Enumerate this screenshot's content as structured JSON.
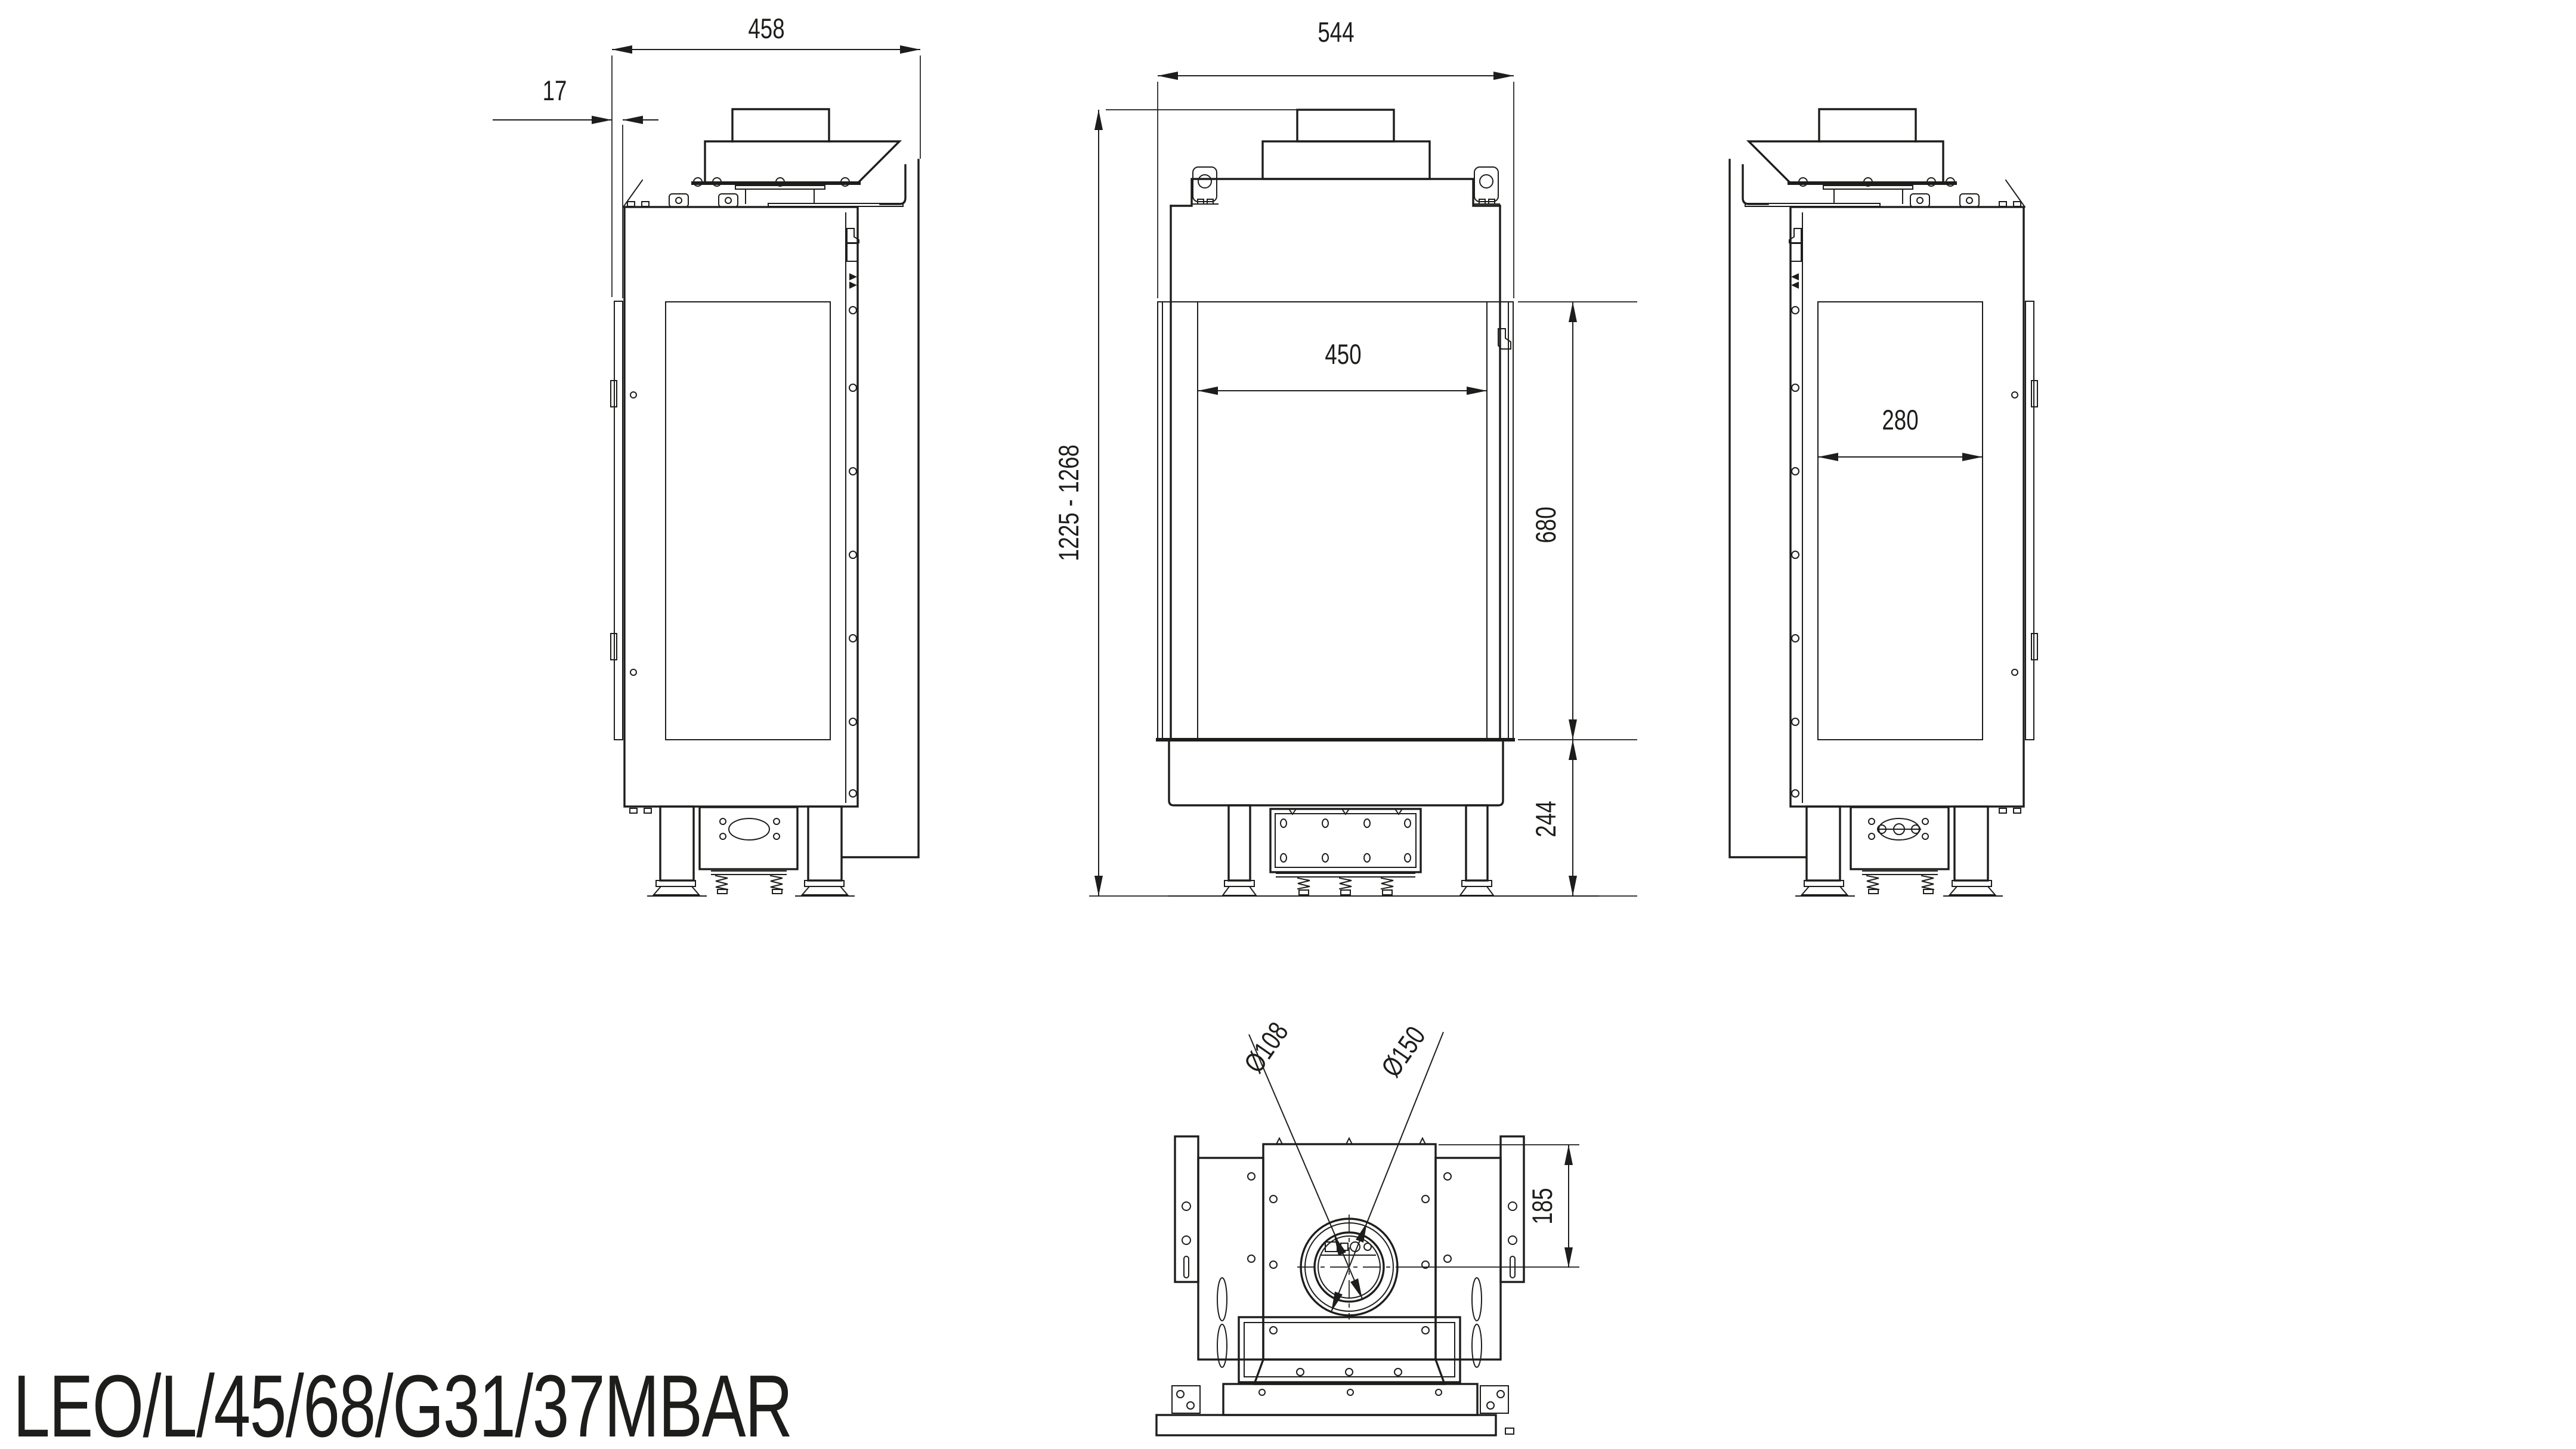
{
  "page": {
    "background": "#ffffff",
    "line_color": "#1d1d1b"
  },
  "title": {
    "product_code": "LEO/L/45/68/G31/37MBAR"
  },
  "dimensions": {
    "depth_overall": "458",
    "glass_front_offset": "17",
    "width_overall": "544",
    "glass_width_front": "450",
    "glass_height": "680",
    "base_height": "244",
    "height_range": "1225 - 1268",
    "glass_width_side": "280",
    "flue_inner_diameter": "Ø108",
    "flue_outer_diameter": "Ø150",
    "flue_center_offset": "185"
  }
}
